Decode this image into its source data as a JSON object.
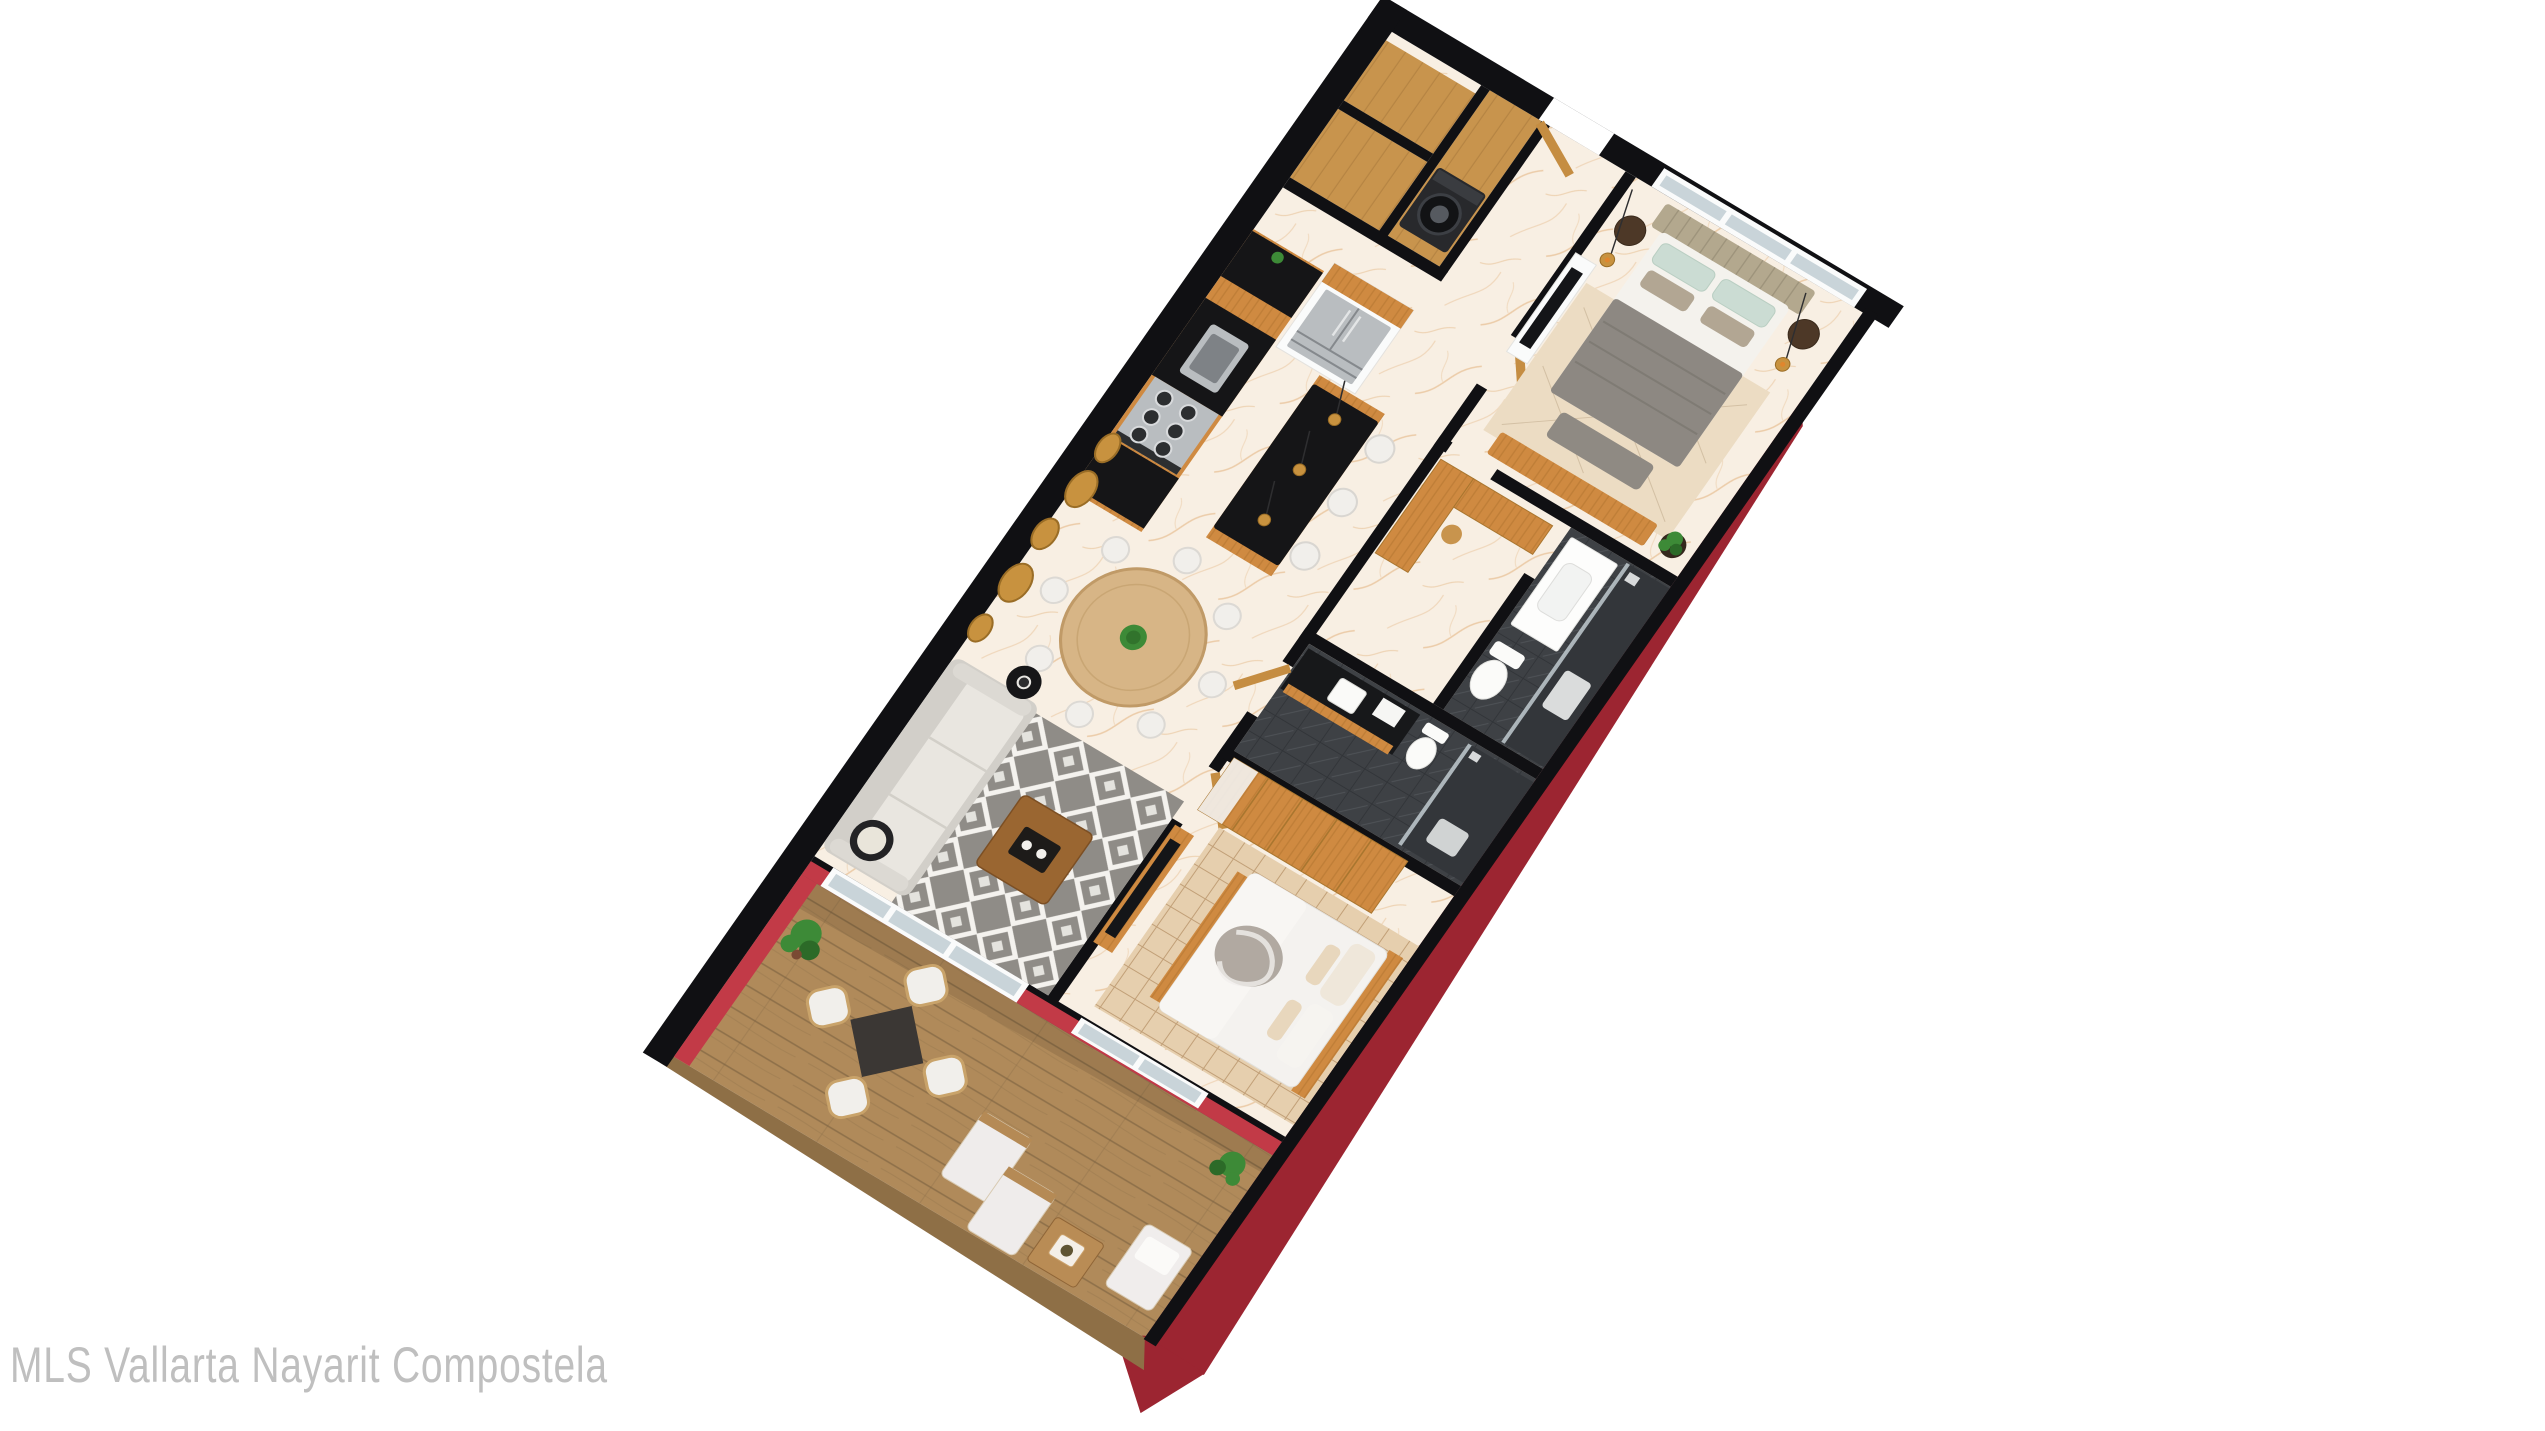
{
  "figure": {
    "type": "3d-floor-plan-render",
    "subject": "Isometric top-down 3D render of a two-bedroom apartment with terrace, rotated on a white background",
    "background": "#ffffff"
  },
  "watermark": {
    "text": "MLS Vallarta Nayarit Compostela"
  },
  "rooms": [
    {
      "id": "entry-hall",
      "label": "entry-hall"
    },
    {
      "id": "laundry",
      "label": "laundry-closet"
    },
    {
      "id": "closets",
      "label": "storage-closets"
    },
    {
      "id": "kitchen",
      "label": "kitchen"
    },
    {
      "id": "dining",
      "label": "dining-area"
    },
    {
      "id": "living",
      "label": "living-room"
    },
    {
      "id": "bedroom-1",
      "label": "master-bedroom"
    },
    {
      "id": "walk-in-closet",
      "label": "walk-in-closet"
    },
    {
      "id": "bathroom-1",
      "label": "master-bathroom"
    },
    {
      "id": "bathroom-2",
      "label": "bathroom-2"
    },
    {
      "id": "bedroom-2",
      "label": "bedroom-2"
    },
    {
      "id": "terrace",
      "label": "terrace"
    }
  ],
  "palette": {
    "bg": "#ffffff",
    "watermark": "#bfbfbf",
    "wall": "#101013",
    "redOuter": "#9c2531",
    "redInner": "#c23a47",
    "marble": "#f8efe3",
    "marbleVein": "#dfa96f",
    "wood": "#cf8a41",
    "woodDark": "#aa6f2a",
    "woodDoor": "#c58d42",
    "woodFloor": "#c8944d",
    "deck": "#b08a5a",
    "deckLine": "#7c6240",
    "counter": "#151517",
    "steel": "#b9bdc0",
    "steelDark": "#85898d",
    "frameWhite": "#fafbfb",
    "glass": "#c9d4d9",
    "sofa": "#d2cfc9",
    "sofaSeat": "#e9e6e0",
    "rugGray": "#8f8c87",
    "rugWhite": "#f4f2ee",
    "tableWood": "#d7b586",
    "chairWhite": "#f1efeb",
    "bedGray": "#8d8882",
    "pillowSage": "#cbdcd3",
    "sheetWhite": "#f4f2ed",
    "headboard": "#b3a88e",
    "rugBeige": "#ecdcc3",
    "bed2": "#f4f2ef",
    "throwGray": "#a8a198",
    "tileRug": "#e6cfae",
    "tileLine": "#c19f77",
    "bathDark": "#3e4145",
    "bathDarker": "#303337",
    "toilet": "#fbfbf9",
    "gold": "#c8923f",
    "goldDark": "#9a6d26",
    "plant": "#3d8a37",
    "plantDark": "#2c6a28",
    "nightstand": "#4d3827",
    "bench": "#8f8a83",
    "tv": "#141518"
  }
}
